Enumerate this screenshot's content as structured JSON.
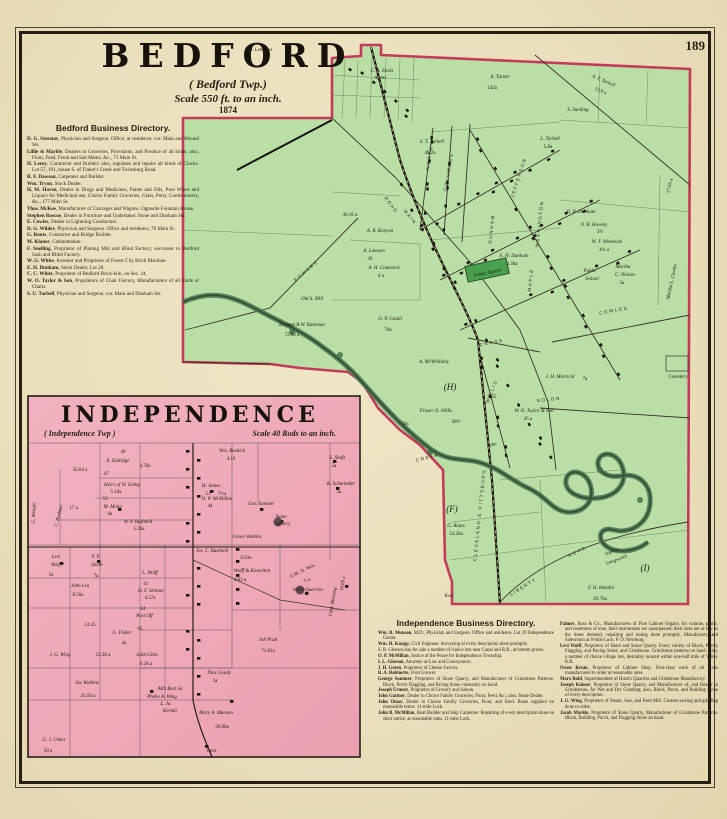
{
  "page": {
    "number": "189"
  },
  "colors": {
    "paper": "#eadfbc",
    "map_green": "#b9dfa6",
    "map_green_edge": "#86b878",
    "public_square_green": "#49a04c",
    "map_pink": "#f0b2c0",
    "map_pink_deep": "#eca0b2",
    "boundary_pink": "#c43a5a",
    "creek": "#4d7752",
    "ink": "#241f12"
  },
  "bedford": {
    "title": "BEDFORD",
    "subtitle": "( Bedford Twp.)",
    "scale": "Scale 550 ft. to an inch.",
    "year": "1874"
  },
  "bedford_directory": {
    "heading": "Bedford Business Directory.",
    "entries": [
      "D. G. Streator, Physician and Surgeon.  Office, at residence, cor. Main and Mound Sts.",
      "Lillie & Marble, Dealers in Groceries, Provisions, and Produce of all kinds; also, Flour, Feed, Fresh and Salt Meats, &c., 73 Main St.",
      "H. Leroy, Contractor and Builder; also, regulates and repairs all kinds of Clocks.  Lot 57, 191, house S. of Tinker's Creek and Twinsburg Road.",
      "R. F. Dawson, Carpenter and Builder.",
      "Wm. Tryon, Stock Dealer.",
      "H. M. Haven, Dealer in Drugs and Medicines, Paints and Oils, Pure Wines and Liquors for Medicinal use, Choice Family Groceries, Glass, Putty, Confectionery, &c., 177 Main St.",
      "Thos. McKee, Manufacturer of Carriages and Wagons. Opposite Fountain House.",
      "Stephen Roscoe, Dealer in Furniture and Undertaker. Stone and Dunham Sts.",
      "E. Cowles, Dealer in Lightning Conductors.",
      "D. G. Wilder, Physician and Surgeon.  Office and residence, 70 Main St.",
      "G. Routs, Contractor and Bridge Builder.",
      "M. Klaner, Cabinetmaker.",
      "F. Snelling, Proprietor of Planing Mill and Blind Factory; successor to Bedford Sash and Blind Factory.",
      "W. G. White, Inventor and Proprietor of Forest City Brick Machine.",
      "E. H. Dunham, Stock Dealer, Lot 28.",
      "C. C. White, Proprietor of Bedford Brick-kiln, on Sec. 24.",
      "W. O. Taylor & Son, Proprietors of Chair Factory, Manufacturers of all kinds of Chairs.",
      "S. U. Tarbell, Physician and Surgeon, cor. Main and Dunham Sts."
    ]
  },
  "independence": {
    "title": "INDEPENDENCE",
    "subtitle": "( Independence Twp )",
    "scale": "Scale 40 Rods to an inch."
  },
  "independence_directory": {
    "heading": "Independence Business Directory.",
    "col1": [
      "Wm. B. Munson, M.D., Physician and Surgeon.  Office and residence, Lot 29 Independence Centre.",
      "Wm. H. Knapp, Civil Engineer.  Surveying of every description done promptly.",
      "S. B. Gleeson has for sale a number of choice lots near Canal and R.R., at bottom prices.",
      "O. P. McMillan, Justice of the Peace for Independence Township.",
      "I. L. Gleeson, Attorney-at-Law and Conveyancer.",
      "J. H. Green, Proprietor of Cheese Factory.",
      "B. A. Robinette, Fruit Grower.",
      "George Sommer, Proprietor of Stone Quarry, and Manufacturer of Grindstone Patterns.  Block, Porch Flagging, and Paving Stone constantly on hand.",
      "Joseph Urmetz, Proprietor of Grocery and Saloon.",
      "John Gattner, Dealer in Choice Family Groceries, Flour, Feed, &c.; also, Stone Dealer.",
      "John Omar, Dealer in Choice Family Groceries, Flour, and Feed.  Boats supplied on reasonable terms.  11-mile Lock.",
      "John B. McMillan, Boat Builder and Ship Carpenter.  Repairing of every description done on short notice, at reasonable rates.  11-mile Lock."
    ],
    "col2": [
      "Palmer, Ross & Co., Manufacturers of Fine Cabinet Organs; for volume, purity, and sweetness of tone, their instruments are unsurpassed; their rates are as low as the times demand; repairing and tuning done promptly.  Manufactory and Salesroom at 8-mile Lock.  P. O. Newburg.",
      "Levi Wolff, Proprietor of Hotel and Stone Quarry. Every variety of Block, Porch, Flagging, and Paving Stone, and Grindstone.  Grindstone patterns on hand.  Also, a number of choice village lots, desirably located within one-half mile of Valley R.R.",
      "Owen Krum, Proprietor of Cabinet Shop.  First-class work of all kinds manufactured to order at reasonable rates.",
      "Marx Buhl, Superintendent of Hurst's Quarries and Grindstone Manufactory.",
      "Joseph Kimser, Proprietor of Stone Quarry, and Manufacturer of, and Dealer in Grindstones, for Wet and Dry Grinding; also, Block, Porch, and Building Stone of every description.",
      "J. G. Wing, Proprietor of Steam, Saw, and Feed Mill. Custom sawing and grinding done to order.",
      "Jacob Markle, Proprietor of Stone Quarry, Manufacturer of Grindstone Patterns.  Block, Building, Porch, and Flagging Stone on hand."
    ]
  },
  "bedford_map": {
    "labels": [
      {
        "t": "J. H. Lemmon",
        "x": 258,
        "y": 51,
        "i": 1
      },
      {
        "t": "C. A. Ennis",
        "x": 382,
        "y": 72,
        "i": 1
      },
      {
        "t": "Agent",
        "x": 380,
        "y": 79,
        "i": 1
      },
      {
        "t": "A. Turner",
        "x": 500,
        "y": 78,
        "i": 1,
        "s": 7
      },
      {
        "t": "142a",
        "x": 492,
        "y": 89
      },
      {
        "t": "A. T. Tarbell",
        "x": 603,
        "y": 82,
        "r": 23,
        "i": 1
      },
      {
        "t": "12.8 a",
        "x": 600,
        "y": 92,
        "r": 23
      },
      {
        "t": "S. Snelling",
        "x": 578,
        "y": 111,
        "i": 1
      },
      {
        "t": "L. Tarbell",
        "x": 550,
        "y": 140,
        "i": 1
      },
      {
        "t": "5.8a",
        "x": 548,
        "y": 148
      },
      {
        "t": "S. T. Tarbell",
        "x": 432,
        "y": 143,
        "i": 1
      },
      {
        "t": "48.2a",
        "x": 430,
        "y": 154
      },
      {
        "t": "38.16 a",
        "x": 350,
        "y": 216
      },
      {
        "t": "A. R. Kenyon",
        "x": 380,
        "y": 232,
        "i": 1
      },
      {
        "t": "A. Lamson",
        "x": 374,
        "y": 252,
        "i": 1
      },
      {
        "t": "30",
        "x": 370,
        "y": 260
      },
      {
        "t": "A. H. Comstock",
        "x": 384,
        "y": 269,
        "i": 1
      },
      {
        "t": "4 a",
        "x": 381,
        "y": 277
      },
      {
        "t": "O. P. Gould",
        "x": 390,
        "y": 320,
        "i": 1,
        "s": 7
      },
      {
        "t": "70a",
        "x": 388,
        "y": 331
      },
      {
        "t": "Old S. Mill",
        "x": 312,
        "y": 300,
        "i": 1
      },
      {
        "t": "Erdman R.W. Bassman",
        "x": 302,
        "y": 326,
        "i": 1
      },
      {
        "t": "72.62 a",
        "x": 292,
        "y": 336
      },
      {
        "t": "POWERS",
        "x": 307,
        "y": 272,
        "r": -40,
        "cls": "street"
      },
      {
        "t": "NORTH",
        "x": 431,
        "y": 158,
        "r": -80,
        "cls": "street"
      },
      {
        "t": "COLUMBUS",
        "x": 450,
        "y": 172,
        "r": -80,
        "cls": "street"
      },
      {
        "t": "JEFFERSON",
        "x": 520,
        "y": 178,
        "r": -72,
        "cls": "street"
      },
      {
        "t": "WASHINGTON",
        "x": 541,
        "y": 224,
        "r": -84,
        "cls": "street"
      },
      {
        "t": "DUNHAM",
        "x": 493,
        "y": 229,
        "r": -84,
        "cls": "street"
      },
      {
        "t": "ROAD",
        "x": 390,
        "y": 206,
        "r": 52,
        "cls": "street"
      },
      {
        "t": "MAIN",
        "x": 409,
        "y": 218,
        "r": 52,
        "cls": "street"
      },
      {
        "t": "MAPLE",
        "x": 532,
        "y": 280,
        "r": -84,
        "cls": "street"
      },
      {
        "t": "WILLIS",
        "x": 493,
        "y": 392,
        "r": -68,
        "cls": "street"
      },
      {
        "t": "CROSS",
        "x": 492,
        "y": 344,
        "r": -12,
        "cls": "street"
      },
      {
        "t": "SOLON",
        "x": 549,
        "y": 401,
        "r": -6,
        "cls": "street"
      },
      {
        "t": "COWLES",
        "x": 614,
        "y": 312,
        "r": -10,
        "cls": "street"
      },
      {
        "t": "LIBERTY",
        "x": 524,
        "y": 588,
        "r": -32,
        "cls": "street"
      },
      {
        "t": "ROAD",
        "x": 578,
        "y": 553,
        "r": -28,
        "cls": "street"
      },
      {
        "t": "CLEVELAND & PITTSBURG",
        "x": 481,
        "y": 515,
        "r": -84,
        "cls": "street",
        "s": 4.2
      },
      {
        "t": "CREEK",
        "x": 428,
        "y": 459,
        "r": -14,
        "cls": "street"
      },
      {
        "t": "Public Square",
        "x": 488,
        "y": 274,
        "i": 1,
        "r": -12
      },
      {
        "t": "E. H. Dunham",
        "x": 514,
        "y": 257,
        "i": 1
      },
      {
        "t": "4.36a",
        "x": 512,
        "y": 265
      },
      {
        "t": "D. B. Dunham",
        "x": 581,
        "y": 213,
        "i": 1
      },
      {
        "t": "N. B. Hawley",
        "x": 594,
        "y": 226,
        "i": 1
      },
      {
        "t": "3½",
        "x": 600,
        "y": 233
      },
      {
        "t": "W. T. Wheelock",
        "x": 607,
        "y": 243,
        "i": 1
      },
      {
        "t": "4¾ a",
        "x": 604,
        "y": 251
      },
      {
        "t": "Public",
        "x": 590,
        "y": 272,
        "i": 1
      },
      {
        "t": "School",
        "x": 592,
        "y": 280,
        "i": 1
      },
      {
        "t": "Martha",
        "x": 623,
        "y": 268,
        "i": 1
      },
      {
        "t": "C. Nelson",
        "x": 625,
        "y": 276,
        "i": 1
      },
      {
        "t": "5a",
        "x": 622,
        "y": 284
      },
      {
        "t": "27.65 a",
        "x": 671,
        "y": 186,
        "r": -78
      },
      {
        "t": "Martha L. Cowles",
        "x": 673,
        "y": 282,
        "r": -78,
        "i": 1
      },
      {
        "t": "Cemetery",
        "x": 678,
        "y": 378,
        "s": 4.2,
        "i": 1
      },
      {
        "t": "(H)",
        "x": 450,
        "y": 390,
        "cls": "big"
      },
      {
        "t": "(F)",
        "x": 452,
        "y": 512,
        "cls": "big"
      },
      {
        "t": "(I)",
        "x": 645,
        "y": 571,
        "cls": "big"
      },
      {
        "t": "A. McWhillohy",
        "x": 434,
        "y": 363,
        "i": 1
      },
      {
        "t": "Fraser O. Willis",
        "x": 436,
        "y": 412,
        "i": 1,
        "s": 6.5
      },
      {
        "t": "50a",
        "x": 405,
        "y": 425
      },
      {
        "t": "38½",
        "x": 456,
        "y": 423
      },
      {
        "t": "9.05",
        "x": 492,
        "y": 398
      },
      {
        "t": "John",
        "x": 492,
        "y": 446,
        "r": -10,
        "i": 1
      },
      {
        "t": "J. H. Morrical",
        "x": 560,
        "y": 378,
        "i": 1
      },
      {
        "t": "7a",
        "x": 585,
        "y": 380
      },
      {
        "t": "W. O. Taylor & Son",
        "x": 534,
        "y": 412,
        "i": 1
      },
      {
        "t": "45 a",
        "x": 528,
        "y": 420
      },
      {
        "t": "G. Routs",
        "x": 456,
        "y": 527,
        "i": 1
      },
      {
        "t": "54.26a",
        "x": 456,
        "y": 535
      },
      {
        "t": "Sophia",
        "x": 612,
        "y": 553,
        "r": -20,
        "i": 1
      },
      {
        "t": "Longworth",
        "x": 617,
        "y": 561,
        "r": -20,
        "i": 1
      },
      {
        "t": "F. H. Hamlin",
        "x": 601,
        "y": 589,
        "i": 1,
        "s": 7
      },
      {
        "t": "29.76a",
        "x": 600,
        "y": 600
      },
      {
        "t": "Kor.",
        "x": 449,
        "y": 597,
        "s": 4.2
      }
    ]
  },
  "independence_map": {
    "labels": [
      {
        "t": "49",
        "x": 123,
        "y": 453
      },
      {
        "t": "E. Eldridge",
        "x": 118,
        "y": 462,
        "i": 1
      },
      {
        "t": "4.76a",
        "x": 145,
        "y": 467
      },
      {
        "t": "56.04 a",
        "x": 80,
        "y": 471
      },
      {
        "t": "47",
        "x": 106,
        "y": 475
      },
      {
        "t": "Heirs of W. Gebig",
        "x": 122,
        "y": 486,
        "i": 1
      },
      {
        "t": "5.10a",
        "x": 116,
        "y": 493
      },
      {
        "t": "53",
        "x": 105,
        "y": 500
      },
      {
        "t": "M. Moler",
        "x": 113,
        "y": 508,
        "i": 1
      },
      {
        "t": "6a",
        "x": 110,
        "y": 515
      },
      {
        "t": "W. P. Bushnell",
        "x": 138,
        "y": 523,
        "i": 1
      },
      {
        "t": "5.36a",
        "x": 139,
        "y": 530
      },
      {
        "t": "G. Mengle",
        "x": 35,
        "y": 513,
        "r": -88,
        "i": 1
      },
      {
        "t": "C. Boshner",
        "x": 60,
        "y": 516,
        "r": -76,
        "i": 1
      },
      {
        "t": "17 a.",
        "x": 74,
        "y": 509
      },
      {
        "t": "Levi",
        "x": 56,
        "y": 558,
        "i": 1
      },
      {
        "t": "Wolff",
        "x": 56,
        "y": 566,
        "i": 1
      },
      {
        "t": "5a",
        "x": 51,
        "y": 576
      },
      {
        "t": "F. F.",
        "x": 96,
        "y": 558,
        "i": 1
      },
      {
        "t": "Smith",
        "x": 97,
        "y": 566,
        "i": 1
      },
      {
        "t": "7a",
        "x": 96,
        "y": 577
      },
      {
        "t": "L. Wolff",
        "x": 150,
        "y": 574,
        "i": 1
      },
      {
        "t": "John Lea",
        "x": 80,
        "y": 587,
        "i": 1,
        "s": 6
      },
      {
        "t": "8.56a",
        "x": 78,
        "y": 596
      },
      {
        "t": "61",
        "x": 146,
        "y": 585
      },
      {
        "t": "D. F. Skinner",
        "x": 151,
        "y": 592,
        "i": 1
      },
      {
        "t": "4.57a",
        "x": 150,
        "y": 599
      },
      {
        "t": "64",
        "x": 143,
        "y": 610
      },
      {
        "t": "Post Off.",
        "x": 145,
        "y": 617,
        "i": 1
      },
      {
        "t": "12.45",
        "x": 90,
        "y": 626
      },
      {
        "t": "G. Fisher",
        "x": 122,
        "y": 634,
        "i": 1
      },
      {
        "t": "4a",
        "x": 124,
        "y": 644
      },
      {
        "t": "65",
        "x": 140,
        "y": 630
      },
      {
        "t": "J. G. Wing",
        "x": 60,
        "y": 656,
        "i": 1,
        "s": 6
      },
      {
        "t": "12.38 a",
        "x": 103,
        "y": 656
      },
      {
        "t": "John Giles",
        "x": 147,
        "y": 656,
        "i": 1
      },
      {
        "t": "6.18 a",
        "x": 146,
        "y": 665
      },
      {
        "t": "Jas Watkins",
        "x": 87,
        "y": 684,
        "i": 1,
        "s": 6
      },
      {
        "t": "43.50 a",
        "x": 88,
        "y": 697
      },
      {
        "t": "Albt Burt 5a",
        "x": 170,
        "y": 690,
        "i": 1
      },
      {
        "t": "Phebe A. Wing",
        "x": 162,
        "y": 698,
        "i": 1
      },
      {
        "t": "L. Ja.",
        "x": 166,
        "y": 705,
        "i": 1
      },
      {
        "t": "Kermit",
        "x": 170,
        "y": 712,
        "i": 1
      },
      {
        "t": "G. J. Usher",
        "x": 54,
        "y": 741,
        "i": 1,
        "s": 6
      },
      {
        "t": "50 a",
        "x": 48,
        "y": 752
      },
      {
        "t": "Mary A. Munson",
        "x": 216,
        "y": 714,
        "i": 1,
        "s": 6
      },
      {
        "t": "20.00a",
        "x": 222,
        "y": 728
      },
      {
        "t": "Cem.",
        "x": 212,
        "y": 752
      },
      {
        "t": "Thos Goudy",
        "x": 219,
        "y": 674,
        "i": 1
      },
      {
        "t": "3a",
        "x": 215,
        "y": 682
      },
      {
        "t": "Job Pratt",
        "x": 268,
        "y": 641,
        "i": 1,
        "s": 7
      },
      {
        "t": "71.81a",
        "x": 268,
        "y": 652
      },
      {
        "t": "Jos. C. Bushnell",
        "x": 212,
        "y": 552,
        "i": 1
      },
      {
        "t": "9.63a",
        "x": 246,
        "y": 559
      },
      {
        "t": "Wolff & Knowlton",
        "x": 252,
        "y": 572,
        "i": 1,
        "s": 6
      },
      {
        "t": "4.03 a",
        "x": 240,
        "y": 581
      },
      {
        "t": "G.M. St. Weis",
        "x": 303,
        "y": 572,
        "r": -26,
        "i": 1
      },
      {
        "t": "5 a.",
        "x": 308,
        "y": 581,
        "r": -26
      },
      {
        "t": "Stone Quarries",
        "x": 308,
        "y": 591,
        "i": 1
      },
      {
        "t": "Cath. Blessing",
        "x": 334,
        "y": 602,
        "r": -80,
        "i": 1
      },
      {
        "t": "10.09 a",
        "x": 344,
        "y": 584,
        "r": -80
      },
      {
        "t": "Wm. Bushick",
        "x": 232,
        "y": 452,
        "i": 1
      },
      {
        "t": "4.10",
        "x": 231,
        "y": 460
      },
      {
        "t": "E. Shaft",
        "x": 337,
        "y": 459,
        "i": 1
      },
      {
        "t": "5a",
        "x": 334,
        "y": 467
      },
      {
        "t": "K. Schmiedler",
        "x": 341,
        "y": 485,
        "i": 1
      },
      {
        "t": "5a",
        "x": 339,
        "y": 493
      },
      {
        "t": "H. James",
        "x": 211,
        "y": 487,
        "i": 1
      },
      {
        "t": "51",
        "x": 208,
        "y": 495
      },
      {
        "t": "7½a",
        "x": 222,
        "y": 495
      },
      {
        "t": "O. P. McMillan",
        "x": 217,
        "y": 500,
        "i": 1
      },
      {
        "t": "44",
        "x": 210,
        "y": 507
      },
      {
        "t": "Geo. Sumner",
        "x": 261,
        "y": 505,
        "i": 1
      },
      {
        "t": "Stone",
        "x": 281,
        "y": 518,
        "i": 1
      },
      {
        "t": "Quarry",
        "x": 283,
        "y": 525,
        "i": 1
      },
      {
        "t": "Green Watkins",
        "x": 247,
        "y": 538,
        "i": 1,
        "s": 6
      }
    ]
  }
}
